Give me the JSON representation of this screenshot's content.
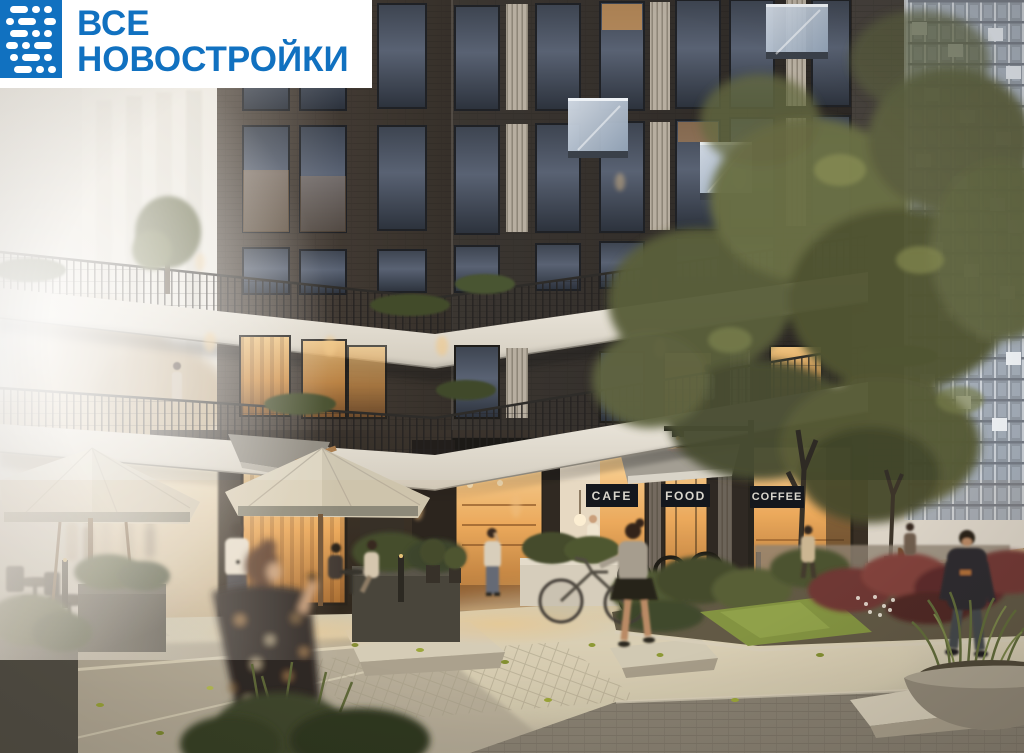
{
  "logo": {
    "line1": "ВСЕ",
    "line2": "НОВОСТРОЙКИ",
    "icon_name": "dot-grid-logo-icon",
    "text_color": "#1171c0",
    "background": "#ffffff"
  },
  "storefront_signs": [
    {
      "label": "CAFE"
    },
    {
      "label": "FOOD"
    },
    {
      "label": "COFFEE"
    }
  ],
  "colors": {
    "brand_blue": "#1171c0",
    "logo_bg": "#ffffff",
    "sign_bg": "#14171d",
    "sign_text": "#d9d6cd",
    "brick": "#3b3631",
    "brick_dark": "#262019",
    "terrace_white": "#f0ebe1",
    "warm_window": "#e9a95e",
    "storefront_glow": "#f3bf7d",
    "haze": "#eae5dc",
    "tower_grey": "#8e939c",
    "glass_balcony": "#a7b4c6",
    "foliage_olive": "#5d6140",
    "foliage_red": "#6e3434",
    "grass_green": "#7f9340",
    "pavement_light": "#cdc5ae",
    "pavement_dark": "#8a857a",
    "umbrella_cream": "#ded7c4",
    "wood_brown": "#8a6a48"
  }
}
